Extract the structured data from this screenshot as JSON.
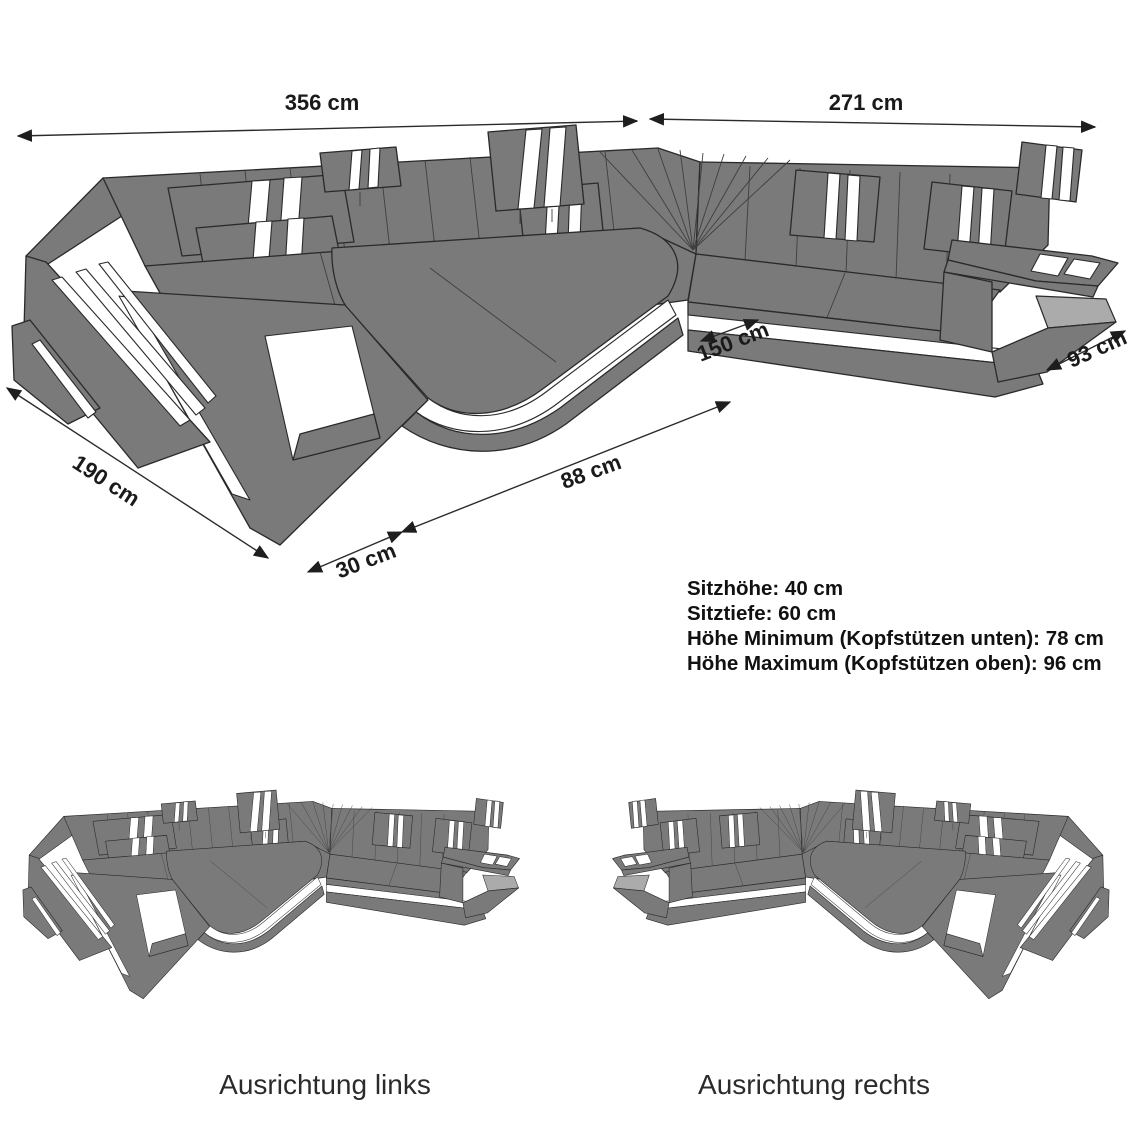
{
  "diagram_title": "Sectional sofa dimensions diagram",
  "dimensions": {
    "back_width_left": "356 cm",
    "back_width_right": "271 cm",
    "depth_left_side": "190 cm",
    "chaise_inner_width": "150 cm",
    "armrest_width": "30 cm",
    "chaise_front_length": "88 cm",
    "right_end_depth": "93 cm"
  },
  "specs": [
    "Sitzhöhe: 40 cm",
    "Sitztiefe: 60 cm",
    "Höhe Minimum (Kopfstützen unten): 78 cm",
    "Höhe Maximum (Kopfstützen oben): 96 cm"
  ],
  "variants": {
    "left": "Ausrichtung links",
    "right": "Ausrichtung rechts"
  },
  "colors": {
    "sofa_grey": "#7a7a7a",
    "outline": "#2a2a2a",
    "accent_white": "#ffffff",
    "shelf_grey": "#ababab",
    "text": "#1a1a1a",
    "bg": "#ffffff"
  }
}
